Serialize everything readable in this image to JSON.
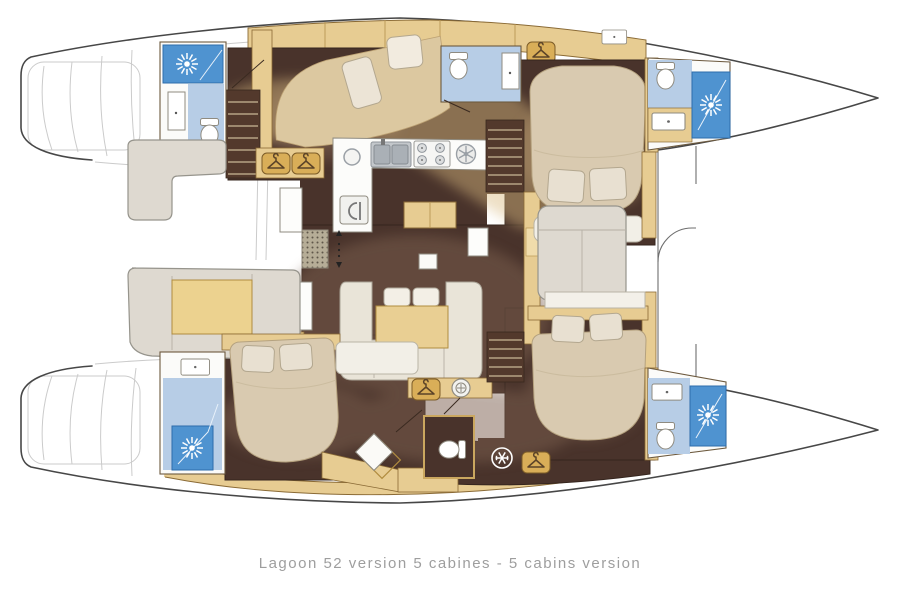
{
  "caption": "Lagoon 52 version 5 cabines - 5 cabins version",
  "palette": {
    "background": "#ffffff",
    "hull_line": "#474747",
    "ghost_line": "#cbcbcb",
    "wood": "#e7cc92",
    "wood_accent": "#d9ae58",
    "wood_border": "#8a6a35",
    "floor_dark": "#49332b",
    "floor_glow": "#7d6150",
    "stair_well": "#53392c",
    "fabric": "#ded9d0",
    "bed": "#d9cab0",
    "pillow": "#ece4d6",
    "bath_floor_blue": "#b7cde6",
    "shower_blue": "#4f93d0",
    "fixture_white": "#ffffff",
    "caption_text": "#9e9e9e"
  },
  "icons": {
    "shower-sun-icon": "sun with rays",
    "wardrobe-hanger-icon": "clothes hanger",
    "freezer-snowflake-icon": "snowflake",
    "washing-machine-icon": "round drum",
    "fridge-icon": "appliance door",
    "stove-icon": "four burners",
    "sink-icon": "basin with tap dot",
    "toilet-icon": "bowl with tank",
    "stairs-icon": "steps",
    "grating-icon": "dotted grate",
    "companionway-arrows-icon": "up-down arrows"
  }
}
